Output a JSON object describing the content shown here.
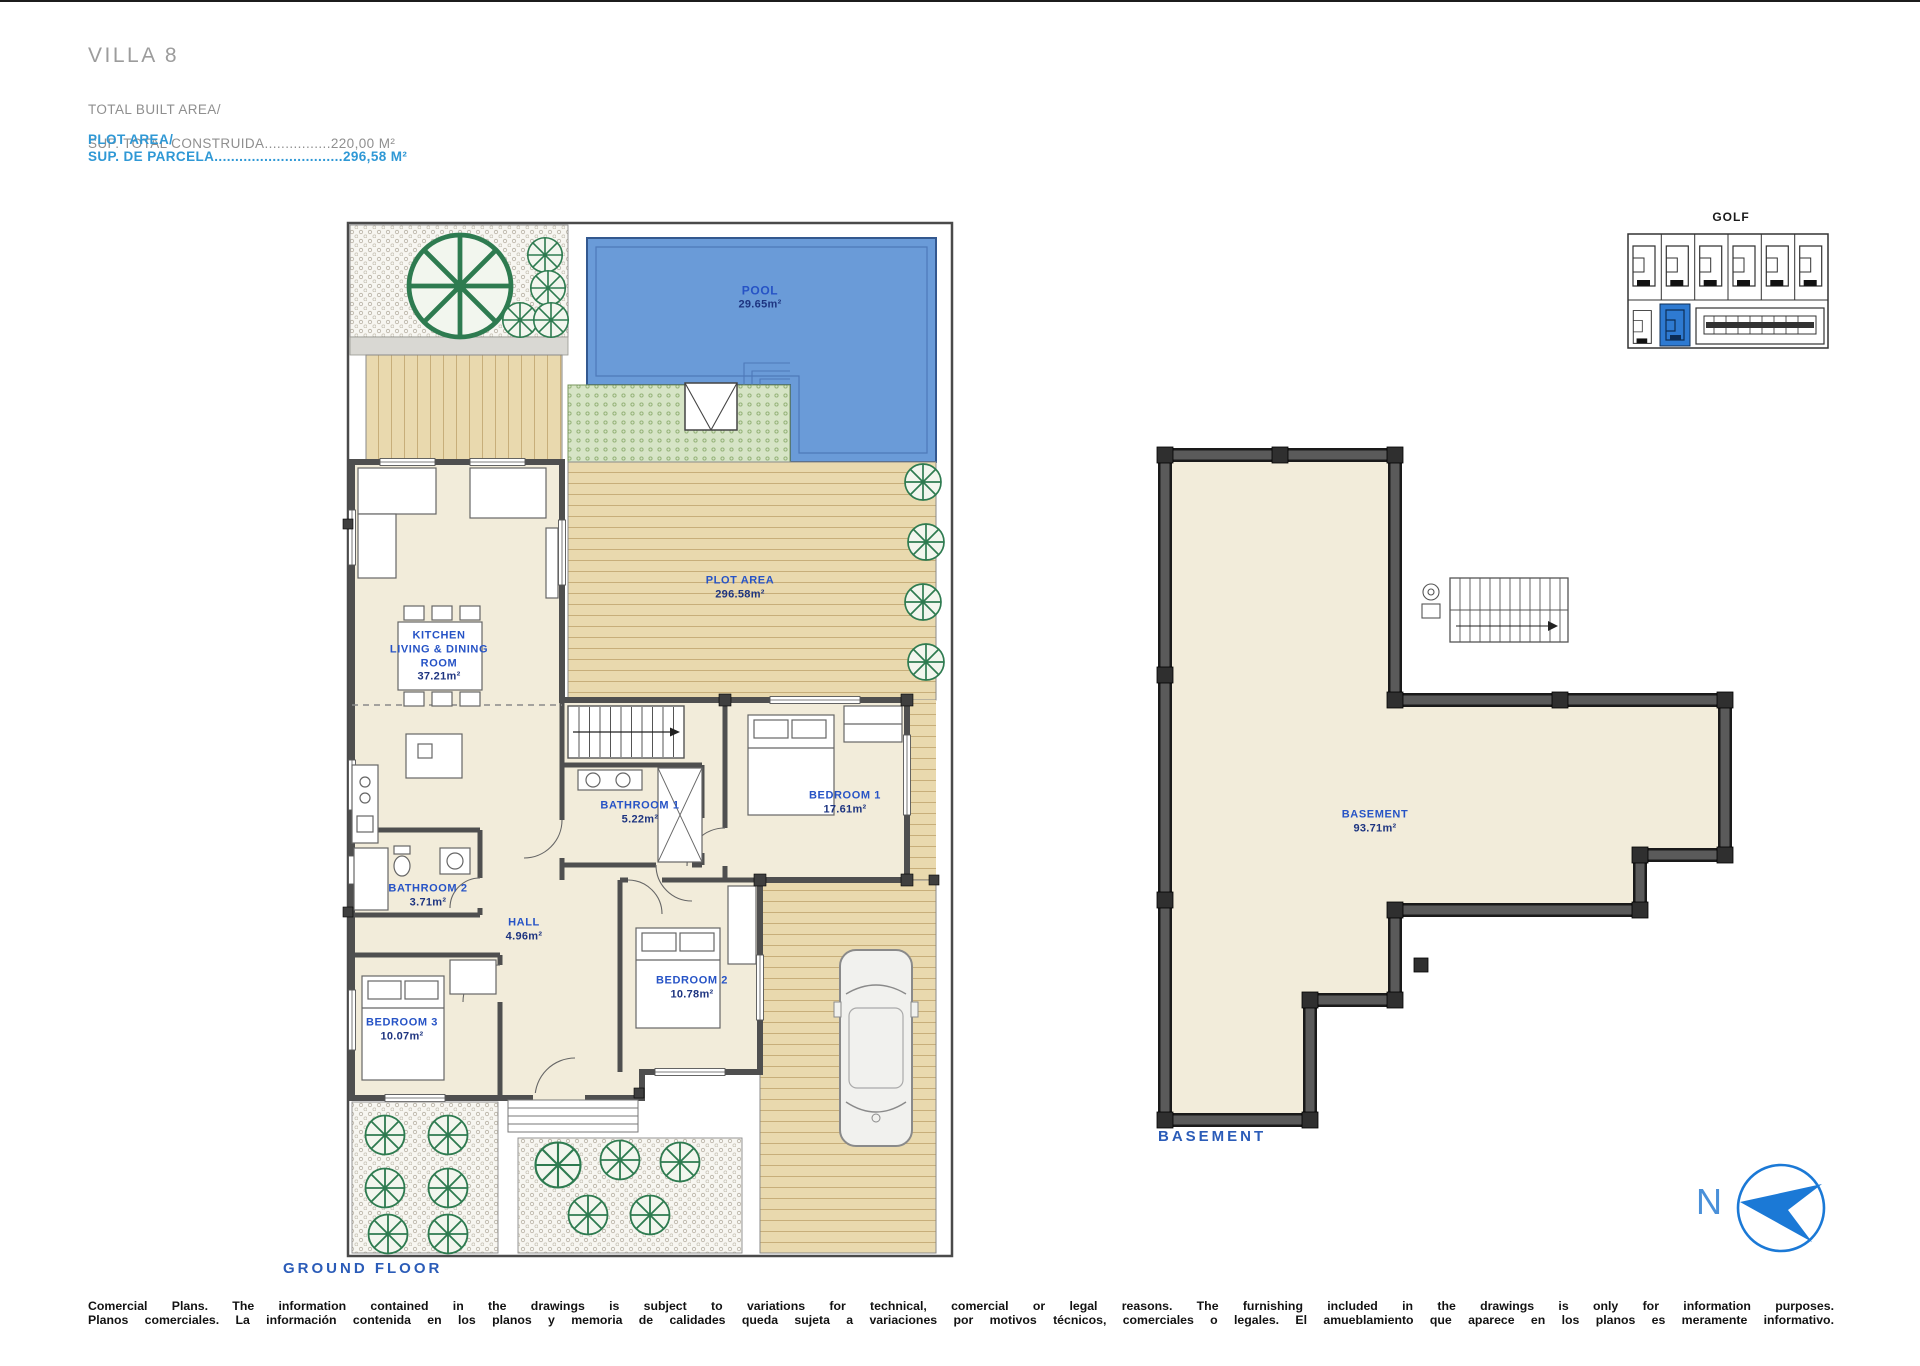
{
  "header": {
    "title": "VILLA 8",
    "built_area_label": "TOTAL BUILT AREA/",
    "built_area_value": "SUP. TOTAL CONSTRUIDA................220,00 M²",
    "plot_area_label": "PLOT AREA/",
    "plot_area_value": "SUP. DE PARCELA...............................296,58 M²"
  },
  "ground_floor": {
    "caption": "GROUND FLOOR",
    "pool": {
      "name": "POOL",
      "area": "29.65m²"
    },
    "plot": {
      "name": "PLOT AREA",
      "area": "296.58m²"
    },
    "kitchen": {
      "line1": "KITCHEN",
      "line2": "LIVING & DINING",
      "line3": "ROOM",
      "area": "37.21m²"
    },
    "bathroom1": {
      "name": "BATHROOM 1",
      "area": "5.22m²"
    },
    "bedroom1": {
      "name": "BEDROOM 1",
      "area": "17.61m²"
    },
    "bathroom2": {
      "name": "BATHROOM 2",
      "area": "3.71m²"
    },
    "hall": {
      "name": "HALL",
      "area": "4.96m²"
    },
    "bedroom2": {
      "name": "BEDROOM 2",
      "area": "10.78m²"
    },
    "bedroom3": {
      "name": "BEDROOM 3",
      "area": "10.07m²"
    }
  },
  "basement": {
    "caption": "BASEMENT",
    "room_name": "BASEMENT",
    "room_area": "93.71m²"
  },
  "site_key": {
    "golf_label": "GOLF"
  },
  "compass": {
    "north_label": "N"
  },
  "footer": {
    "line_en": "Comercial Plans. The information contained in the drawings is subject to variations for technical, comercial or legal reasons. The furnishing included in the drawings is only for information purposes.",
    "line_es": "Planos comerciales. La información contenida en los planos y memoria de calidades queda sujeta a variaciones por motivos técnicos, comerciales o legales. El amueblamiento que aparece en los planos es meramente informativo."
  },
  "colors": {
    "accent_blue": "#2653c6",
    "header_blue": "#2f98d5",
    "pool_blue": "#6a9bd8",
    "highlight_blue": "#2e7ad1",
    "compass_blue": "#1b79d6"
  }
}
